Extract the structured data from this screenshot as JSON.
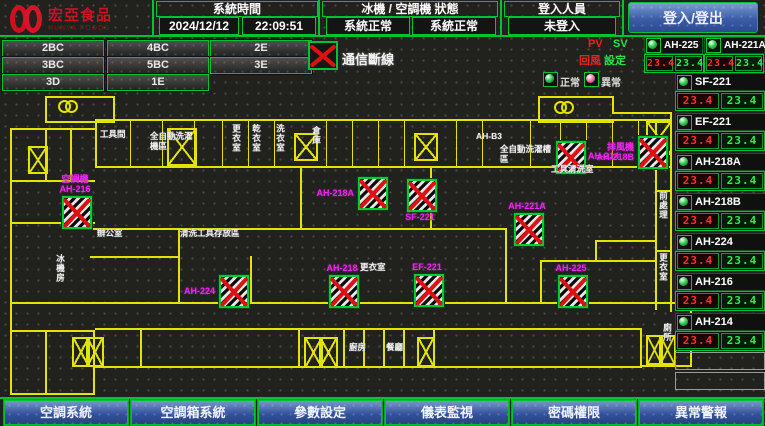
{
  "header": {
    "logo_title": "宏亞食品",
    "logo_subtitle": "HUNYA FOODS",
    "system_time_label": "系統時間",
    "date": "2024/12/12",
    "time": "22:09:51",
    "machine_status_label": "冰機 / 空調機 狀態",
    "chiller_status": "系統正常",
    "ac_status": "系統正常",
    "login_label": "登入人員",
    "login_status": "未登入",
    "login_button": "登入/登出"
  },
  "floor_buttons": [
    "2BC",
    "4BC",
    "2E",
    "3BC",
    "5BC",
    "3E",
    "3D",
    "1E"
  ],
  "legend": {
    "comm_loss": "通信斷線",
    "pv": "PV",
    "sv": "SV",
    "pv_label": "回風",
    "sv_label": "設定",
    "normal": "正常",
    "abnormal": "異常"
  },
  "units": [
    {
      "name": "AH-225",
      "pv": "23.4",
      "sv": "23.4"
    },
    {
      "name": "AH-221A",
      "pv": "23.4",
      "sv": "23.4"
    },
    {
      "name": "SF-221",
      "pv": "23.4",
      "sv": "23.4"
    },
    {
      "name": "EF-221",
      "pv": "23.4",
      "sv": "23.4"
    },
    {
      "name": "AH-218A",
      "pv": "23.4",
      "sv": "23.4"
    },
    {
      "name": "AH-218B",
      "pv": "23.4",
      "sv": "23.4"
    },
    {
      "name": "AH-224",
      "pv": "23.4",
      "sv": "23.4"
    },
    {
      "name": "AH-216",
      "pv": "23.4",
      "sv": "23.4"
    },
    {
      "name": "AH-214",
      "pv": "23.4",
      "sv": "23.4"
    }
  ],
  "plan": {
    "equipment": [
      {
        "name": "AH-216",
        "label_lines": [
          "空調機",
          "AH-216"
        ],
        "x": 62,
        "y": 106,
        "label_pos": "above"
      },
      {
        "name": "AH-218A",
        "label_lines": [
          "AH-218A"
        ],
        "x": 358,
        "y": 87,
        "label_pos": "left"
      },
      {
        "name": "SF-221",
        "label_lines": [
          "SF-221"
        ],
        "x": 407,
        "y": 89,
        "label_pos": "below"
      },
      {
        "name": "AH-221A",
        "label_lines": [
          "AH-221A"
        ],
        "x": 514,
        "y": 123,
        "label_pos": "above"
      },
      {
        "name": "AH-214",
        "label_lines": [
          "AH-214"
        ],
        "x": 556,
        "y": 51,
        "label_pos": "right"
      },
      {
        "name": "AH-218B",
        "label_lines": [
          "排風機",
          "AH-218B"
        ],
        "x": 638,
        "y": 46,
        "label_pos": "left"
      },
      {
        "name": "AH-224",
        "label_lines": [
          "AH-224"
        ],
        "x": 219,
        "y": 185,
        "label_pos": "left"
      },
      {
        "name": "AH-218",
        "label_lines": [
          "AH-218"
        ],
        "x": 329,
        "y": 185,
        "label_pos": "above"
      },
      {
        "name": "EF-221",
        "label_lines": [
          "EF-221"
        ],
        "x": 414,
        "y": 184,
        "label_pos": "above"
      },
      {
        "name": "AH-225",
        "label_lines": [
          "AH-225"
        ],
        "x": 558,
        "y": 185,
        "label_pos": "above"
      }
    ],
    "room_labels": [
      {
        "text": "工具間",
        "x": 100,
        "y": 40,
        "w": 26
      },
      {
        "text": "全自動洗濯機區",
        "x": 150,
        "y": 42,
        "w": 46
      },
      {
        "text": "更衣室",
        "x": 231,
        "y": 34,
        "vertical": true
      },
      {
        "text": "乾衣室",
        "x": 251,
        "y": 34,
        "vertical": true
      },
      {
        "text": "洗衣室",
        "x": 275,
        "y": 34,
        "vertical": true
      },
      {
        "text": "倉庫",
        "x": 311,
        "y": 36,
        "vertical": true
      },
      {
        "text": "AH-B3",
        "x": 476,
        "y": 42
      },
      {
        "text": "全自動洗濯槽區",
        "x": 500,
        "y": 55,
        "w": 52
      },
      {
        "text": "工具清洗室",
        "x": 551,
        "y": 75
      },
      {
        "text": "辦公室",
        "x": 97,
        "y": 139
      },
      {
        "text": "清洗工具存放區",
        "x": 180,
        "y": 139
      },
      {
        "text": "更衣室",
        "x": 360,
        "y": 173
      },
      {
        "text": "前處理",
        "x": 658,
        "y": 101,
        "vertical": true
      },
      {
        "text": "更衣室",
        "x": 658,
        "y": 163,
        "vertical": true
      },
      {
        "text": "冰機房",
        "x": 55,
        "y": 164,
        "vertical": true
      },
      {
        "text": "廚房",
        "x": 349,
        "y": 253
      },
      {
        "text": "餐廳",
        "x": 386,
        "y": 253
      },
      {
        "text": "廁所",
        "x": 662,
        "y": 233,
        "vertical": true
      }
    ]
  },
  "bottom_nav": [
    {
      "id": "ac-system",
      "label": "空調系統"
    },
    {
      "id": "ahu-system",
      "label": "空調箱系統"
    },
    {
      "id": "param-settings",
      "label": "參數設定"
    },
    {
      "id": "meter-monitor",
      "label": "儀表監視"
    },
    {
      "id": "password-auth",
      "label": "密碼權限"
    },
    {
      "id": "alarm",
      "label": "異常警報"
    }
  ],
  "colors": {
    "accent_green": "#00c233",
    "alarm_red": "#dd1111",
    "wall_yellow": "#e3e300",
    "label_magenta": "#e62ae6",
    "seg_red": "#ff3020",
    "seg_green": "#2bf04e",
    "logo_red": "#cc1122",
    "button_blue": "#31509a"
  }
}
